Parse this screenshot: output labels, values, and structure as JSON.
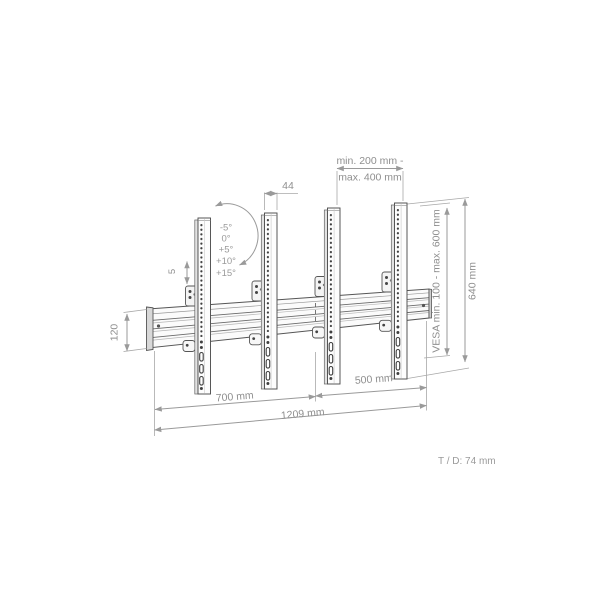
{
  "dims": {
    "rail_width_44": "44",
    "spacing_min": "min. 200 mm -",
    "spacing_max": "max. 400 mm",
    "height_640": "640 mm",
    "vesa": "VESA min. 100 - max. 600 mm",
    "section_700": "700 mm",
    "section_500": "500 mm",
    "total_1209": "1209 mm",
    "bar_120": "120",
    "adjust_5": "5"
  },
  "tilt": {
    "angles": [
      "-5°",
      "0°",
      "+5°",
      "+10°",
      "+15°"
    ]
  },
  "footnote": {
    "text": "T / D: 74 mm"
  },
  "colors": {
    "structure_line": "#555555",
    "dimension_line": "#9a9a9a",
    "label_text": "#8f8f8f",
    "background": "#ffffff"
  }
}
